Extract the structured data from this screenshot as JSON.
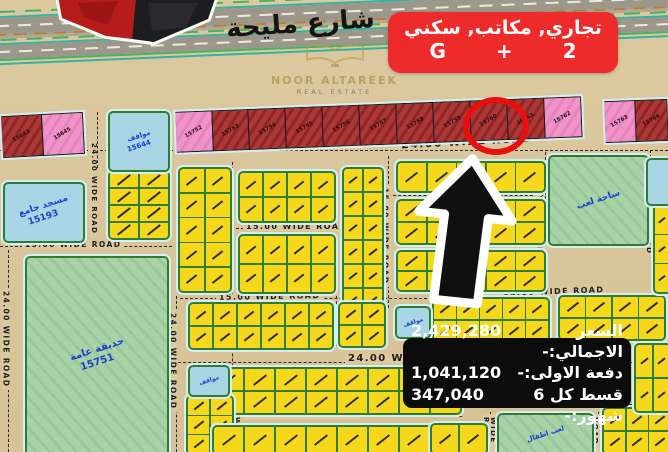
{
  "header": {
    "street_label": "شارع مليحة",
    "info_box": {
      "line1": "تجاري, مكاتب, سكني",
      "g": "G",
      "plus": "+",
      "two": "2"
    },
    "watermark": {
      "name": "NOOR ALTAREEK",
      "tagline": "REAL ESTATE"
    }
  },
  "price_box": {
    "rows": [
      {
        "label": "السعر الاجمالي:-",
        "value": "2,429,280"
      },
      {
        "label": "دفعة الاولى:-",
        "value": "1,041,120"
      },
      {
        "label": "قسط كل 6 شهور:-",
        "value": "347,040"
      }
    ]
  },
  "map": {
    "colors": {
      "sand": "#dcc9a0",
      "accent_red": "#ee2b2b",
      "plot_yellow": "#f5d81c",
      "plot_red": "#a03030",
      "plot_pink": "#ef8cc5",
      "plot_blue": "#a7d5e3",
      "plot_green": "#a9d3a7",
      "road_green_border": "#2e7d32",
      "sidewalk_blue": "#d6edf1",
      "highlight_ring": "#e80f0f",
      "price_box_bg": "#0c0c0c"
    },
    "highlighted_plot": "15760",
    "highlight_circle": {
      "x": 463,
      "y": 97,
      "w": 54,
      "h": 46
    },
    "commercial_groups": [
      {
        "x": 2,
        "y": 114,
        "w": 82,
        "h": 42,
        "angle": -3,
        "plots": [
          {
            "n": "15643",
            "c": "red"
          },
          {
            "n": "15645",
            "c": "pink"
          }
        ]
      },
      {
        "x": 176,
        "y": 104,
        "w": 406,
        "h": 41,
        "angle": -2.2,
        "plots": [
          {
            "n": "15752",
            "c": "pink"
          },
          {
            "n": "15753",
            "c": "red"
          },
          {
            "n": "15754",
            "c": "red"
          },
          {
            "n": "15755",
            "c": "red"
          },
          {
            "n": "15756",
            "c": "red"
          },
          {
            "n": "15757",
            "c": "red"
          },
          {
            "n": "15758",
            "c": "red"
          },
          {
            "n": "15759",
            "c": "red"
          },
          {
            "n": "15760",
            "c": "red"
          },
          {
            "n": "15761",
            "c": "red"
          },
          {
            "n": "15762",
            "c": "pink"
          }
        ]
      },
      {
        "x": 605,
        "y": 100,
        "w": 63,
        "h": 42,
        "angle": -2,
        "plots": [
          {
            "n": "15763",
            "c": "pink"
          },
          {
            "n": "15764",
            "c": "red"
          }
        ]
      }
    ],
    "special_plots": [
      {
        "name": "mosque-plot",
        "x": 3,
        "y": 182,
        "w": 78,
        "h": 57,
        "cls": "blue",
        "fs": 9,
        "lines": [
          "مسجد جامع",
          "15193"
        ]
      },
      {
        "name": "public-park-plot",
        "x": 25,
        "y": 256,
        "w": 140,
        "h": 196,
        "cls": "green",
        "fs": 10,
        "lines": [
          "حديقة عامة",
          "15751"
        ]
      },
      {
        "name": "playground-plot",
        "x": 548,
        "y": 155,
        "w": 97,
        "h": 87,
        "cls": "green",
        "fs": 9,
        "lines": [
          "ساحة لعب"
        ]
      },
      {
        "name": "parking-plot-15644",
        "x": 108,
        "y": 111,
        "w": 58,
        "h": 57,
        "cls": "blue",
        "fs": 7,
        "lines": [
          "مواقف",
          "15644"
        ]
      },
      {
        "name": "parking-plot-small-1",
        "x": 395,
        "y": 306,
        "w": 32,
        "h": 29,
        "cls": "blue",
        "fs": 6,
        "lines": [
          "مواقف"
        ]
      },
      {
        "name": "parking-plot-small-2",
        "x": 188,
        "y": 365,
        "w": 38,
        "h": 28,
        "cls": "blue",
        "fs": 6,
        "lines": [
          "مواقف"
        ]
      },
      {
        "name": "kids-play-plot",
        "x": 497,
        "y": 413,
        "w": 93,
        "h": 39,
        "cls": "green",
        "fs": 7,
        "lines": [
          "لعب اطفال"
        ]
      },
      {
        "name": "blue-plot-partial",
        "x": 646,
        "y": 158,
        "w": 22,
        "h": 44,
        "cls": "blue",
        "fs": 6,
        "lines": []
      }
    ],
    "blocks": [
      [
        108,
        170,
        58,
        66,
        2,
        4
      ],
      [
        178,
        167,
        50,
        122,
        2,
        5
      ],
      [
        238,
        171,
        94,
        48,
        4,
        2
      ],
      [
        238,
        234,
        94,
        56,
        4,
        2
      ],
      [
        342,
        167,
        38,
        142,
        2,
        6
      ],
      [
        396,
        161,
        146,
        28,
        5,
        1
      ],
      [
        396,
        199,
        146,
        42,
        5,
        2
      ],
      [
        396,
        250,
        146,
        38,
        5,
        2
      ],
      [
        188,
        302,
        142,
        44,
        6,
        2
      ],
      [
        338,
        302,
        44,
        42,
        2,
        2
      ],
      [
        432,
        297,
        114,
        42,
        5,
        2
      ],
      [
        558,
        295,
        104,
        42,
        4,
        2
      ],
      [
        212,
        367,
        246,
        44,
        8,
        2
      ],
      [
        186,
        395,
        44,
        56,
        2,
        3
      ],
      [
        212,
        425,
        246,
        26,
        8,
        1
      ],
      [
        602,
        407,
        66,
        44,
        3,
        2
      ],
      [
        430,
        423,
        54,
        28,
        2,
        1
      ],
      [
        653,
        204,
        15,
        86,
        1,
        3
      ],
      [
        634,
        343,
        34,
        66,
        2,
        2
      ]
    ],
    "road_labels_h": [
      [
        "24.00  WIDE  ROAD",
        398,
        136,
        11,
        -3
      ],
      [
        "15.00 WIDE ROAD",
        22,
        241,
        7.5,
        0
      ],
      [
        "15.00  WIDE  ROAD",
        243,
        223,
        8,
        0
      ],
      [
        "15.00 WIDE ROAD",
        452,
        242,
        7,
        0
      ],
      [
        "15.00 WIDE ROAD",
        216,
        293,
        8,
        -1
      ],
      [
        "15.00 WIDE ROAD",
        500,
        288,
        8,
        -2
      ],
      [
        "24.00  WIDE  ROAD",
        345,
        354,
        10,
        0
      ],
      [
        "15.00  WIDE  ROAD",
        243,
        411,
        9,
        0
      ],
      [
        "15.00 WIDE ROAD",
        398,
        189,
        6,
        0
      ]
    ],
    "road_labels_v": [
      [
        "24.00 WIDE ROAD",
        90,
        140,
        7
      ],
      [
        "24.00 WIDE ROAD",
        2,
        288,
        7.5
      ],
      [
        "24.00 WIDE ROAD",
        169,
        310,
        7.5
      ],
      [
        "15.00 WIDE ROAD",
        226,
        183,
        7.5
      ],
      [
        "15.00 WIDE ROAD",
        381,
        185,
        7.5
      ],
      [
        "15.00 WIDE ROAD",
        535,
        160,
        7
      ],
      [
        "15.00 WIDE ROAD",
        645,
        160,
        7
      ],
      [
        "15.00 WIDE ROAD",
        226,
        381,
        7
      ],
      [
        "WIDE ROAD",
        482,
        414,
        7
      ],
      [
        "WIDE ROAD",
        591,
        414,
        7
      ],
      [
        "15.00 WIDE ROAD",
        655,
        298,
        7
      ]
    ],
    "dashes_h": [
      [
        0,
        150,
        668
      ],
      [
        393,
        195,
        150
      ],
      [
        236,
        228,
        98
      ],
      [
        0,
        246,
        172
      ],
      [
        428,
        246,
        118
      ],
      [
        180,
        298,
        252
      ],
      [
        468,
        292,
        132
      ],
      [
        168,
        362,
        500
      ],
      [
        186,
        416,
        276
      ],
      [
        598,
        404,
        70
      ]
    ],
    "dashes_v": [
      [
        97,
        112,
        56
      ],
      [
        8,
        250,
        202
      ],
      [
        176,
        296,
        156
      ],
      [
        232,
        162,
        290
      ],
      [
        336,
        296,
        50
      ],
      [
        388,
        156,
        152
      ],
      [
        545,
        152,
        102
      ],
      [
        650,
        150,
        104
      ],
      [
        490,
        412,
        40
      ],
      [
        598,
        412,
        40
      ],
      [
        660,
        296,
        112
      ]
    ]
  }
}
